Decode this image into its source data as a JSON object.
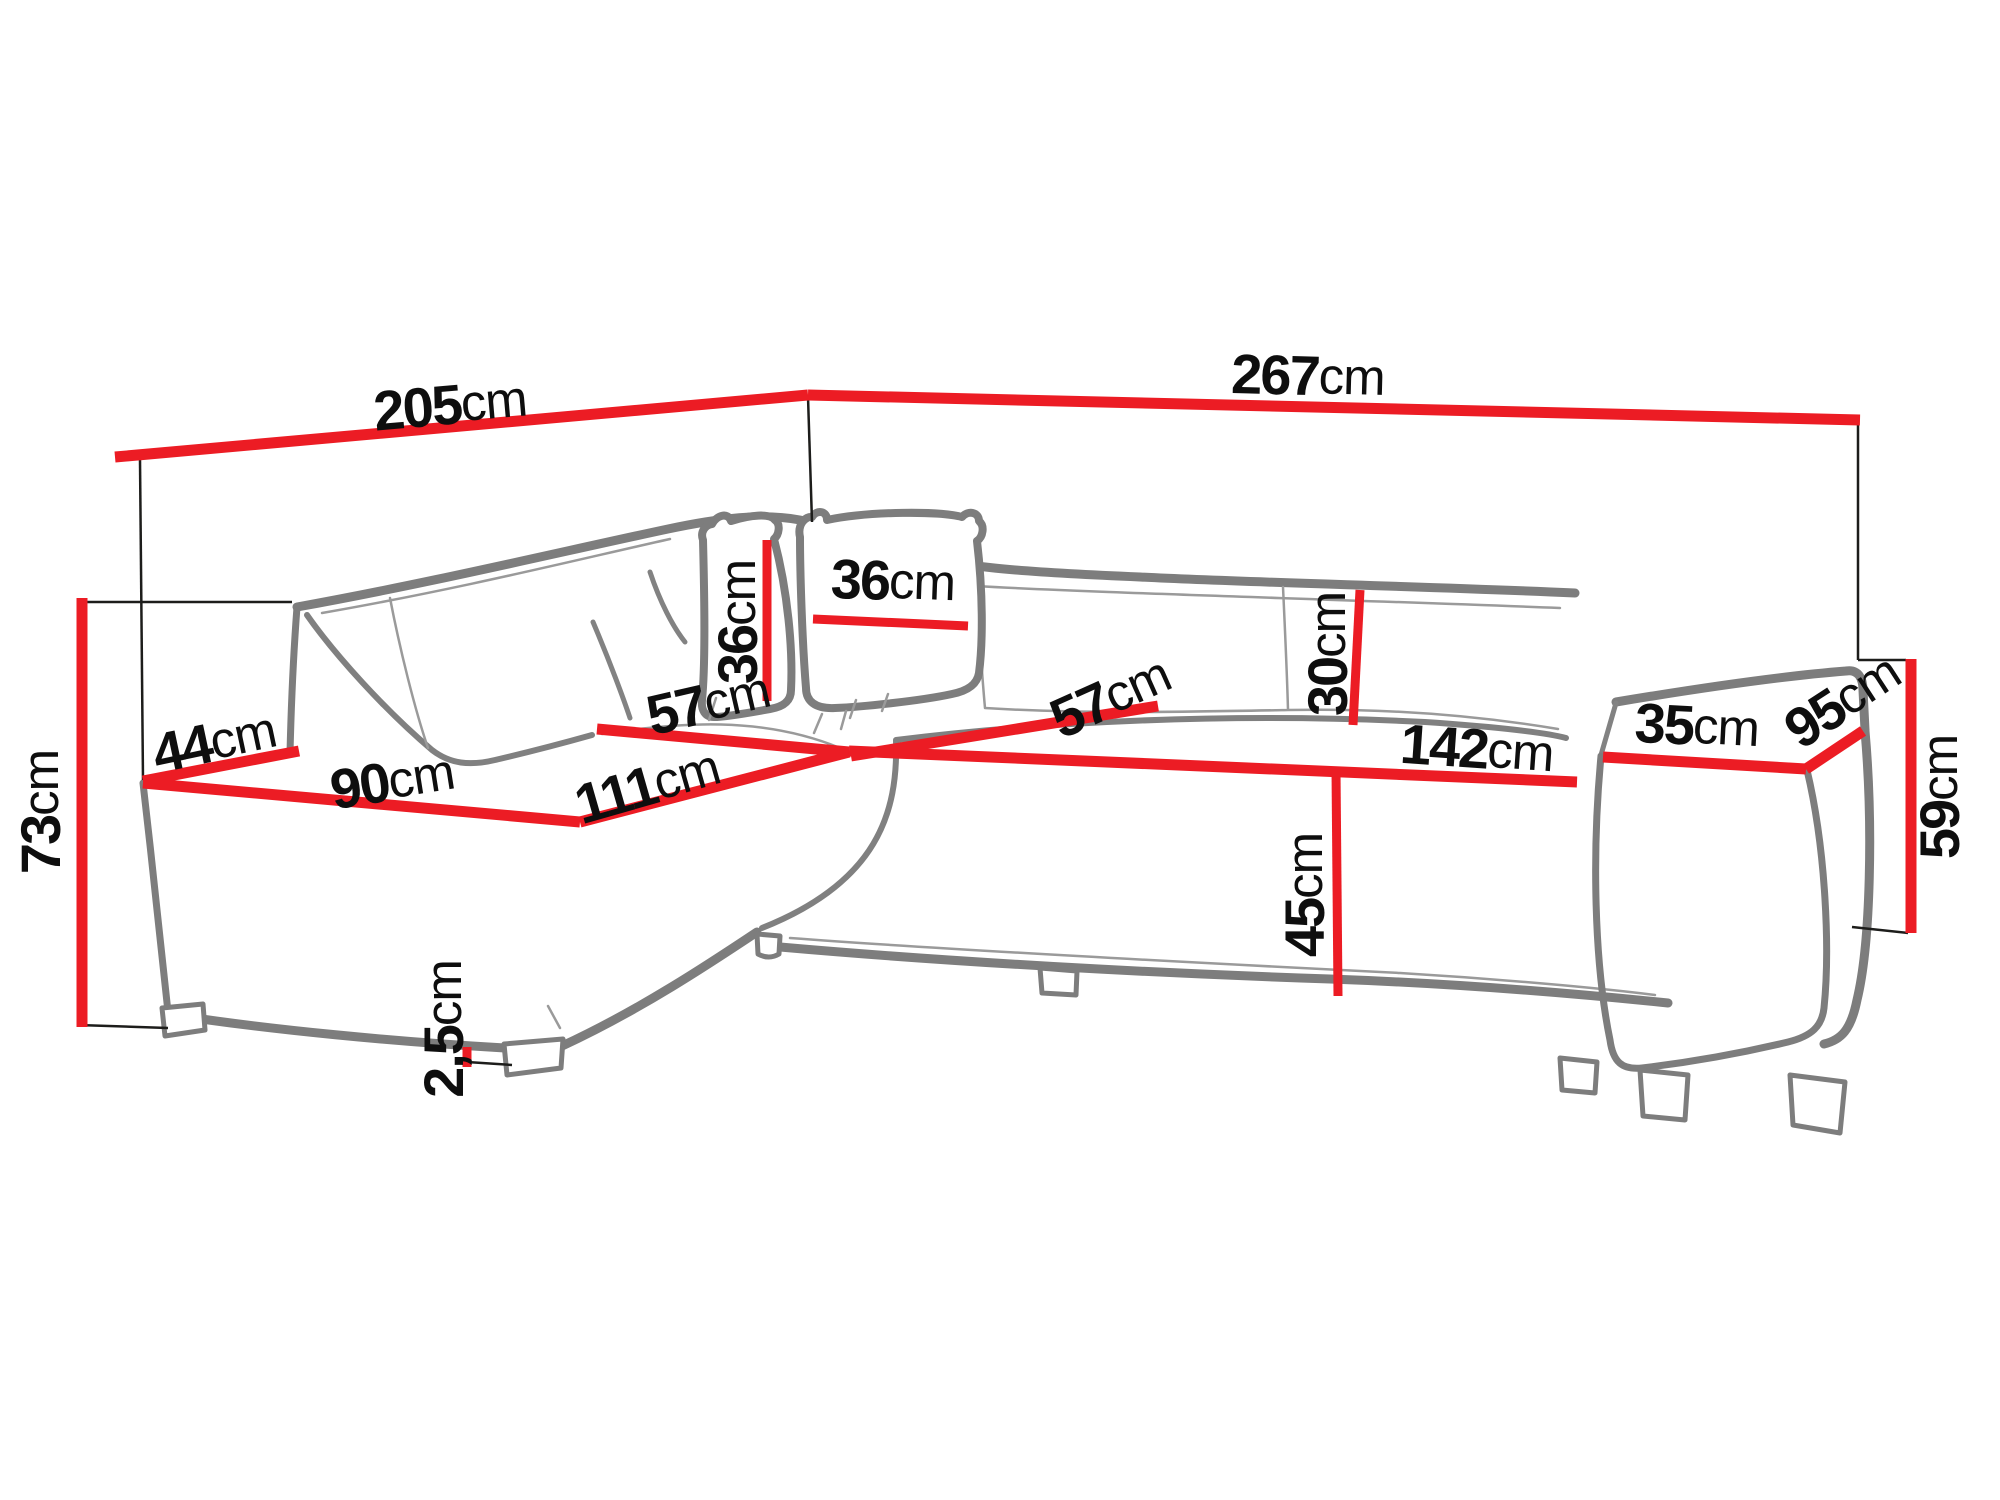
{
  "diagram": {
    "subject": "corner sofa with pillows - dimension drawing",
    "accent_color": "#ec1c24",
    "outline_color": "#7d7d7d",
    "unit": "cm"
  },
  "dims": {
    "back_left": {
      "value": "205",
      "unit": "cm"
    },
    "back_right": {
      "value": "267",
      "unit": "cm"
    },
    "height_back": {
      "value": "73",
      "unit": "cm"
    },
    "end_width": {
      "value": "44",
      "unit": "cm"
    },
    "chaise_width": {
      "value": "90",
      "unit": "cm"
    },
    "chaise_depth": {
      "value": "111",
      "unit": "cm"
    },
    "corner_seat": {
      "value": "57",
      "unit": "cm"
    },
    "seat_depth": {
      "value": "57",
      "unit": "cm"
    },
    "seat_width": {
      "value": "142",
      "unit": "cm"
    },
    "cushion_height": {
      "value": "36",
      "unit": "cm"
    },
    "cushion_width": {
      "value": "36",
      "unit": "cm"
    },
    "backrest_above_seat": {
      "value": "30",
      "unit": "cm"
    },
    "seat_height": {
      "value": "45",
      "unit": "cm"
    },
    "armrest_width": {
      "value": "35",
      "unit": "cm"
    },
    "depth_total": {
      "value": "95",
      "unit": "cm"
    },
    "armrest_height": {
      "value": "59",
      "unit": "cm"
    },
    "foot_height": {
      "value": "2,5",
      "unit": "cm"
    }
  }
}
